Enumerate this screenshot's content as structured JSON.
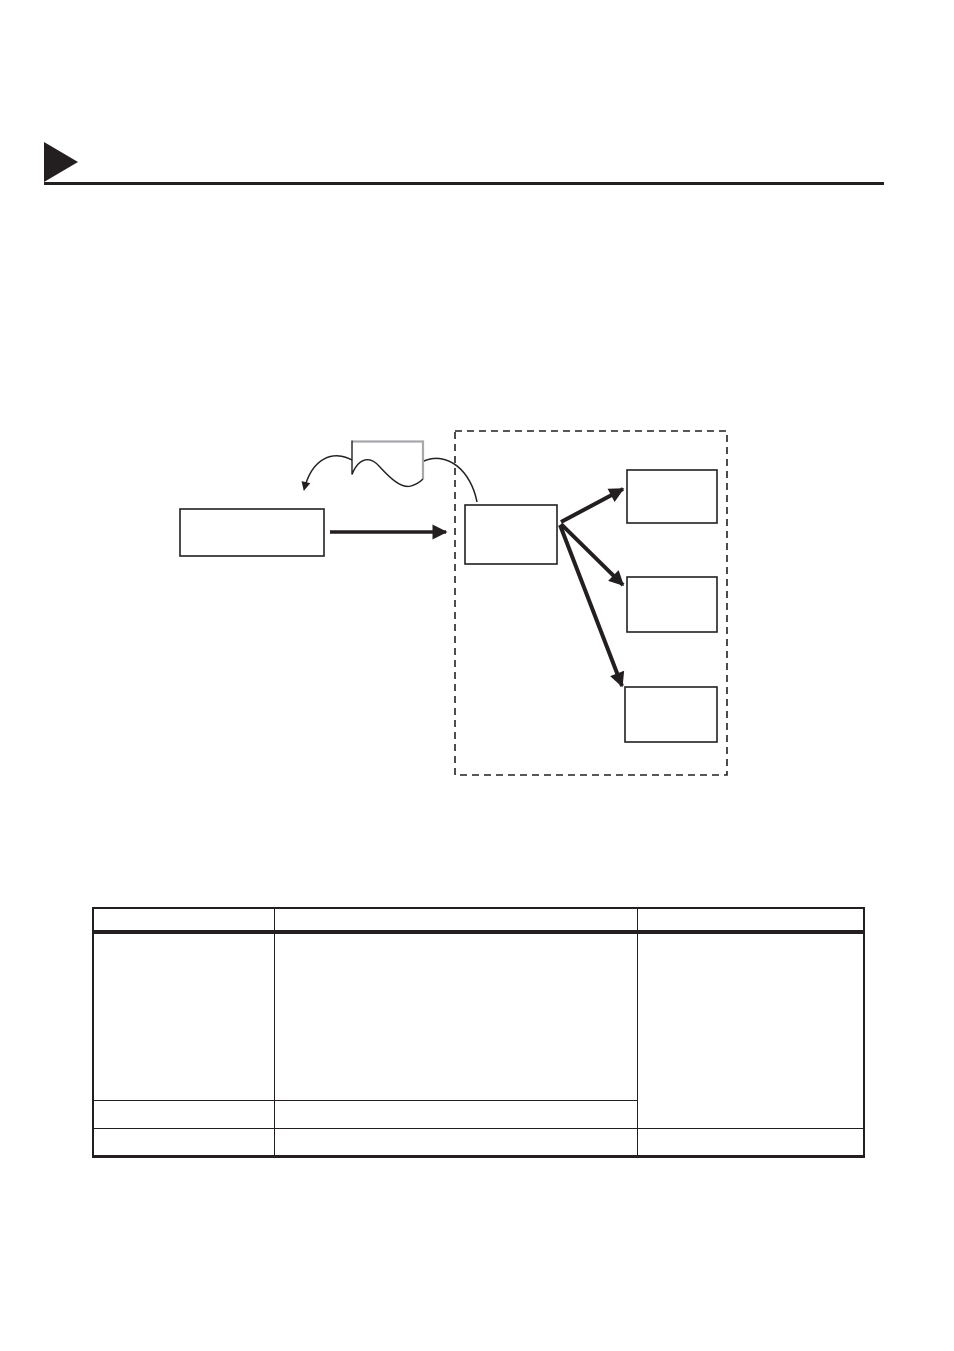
{
  "page": {
    "background_color": "#ffffff",
    "ink_color": "#231f20",
    "gray_accent_color": "#a7a9ac"
  },
  "header": {
    "marker_shape": "filled-right-triangle",
    "title_text": ""
  },
  "diagram": {
    "source_box_label": "",
    "document_shape_label": "",
    "hub_box_label": "",
    "destination_box_labels": [
      "",
      "",
      ""
    ],
    "group_outline_style": "dashed"
  },
  "table": {
    "header_cells": [
      "",
      "",
      ""
    ],
    "body": {
      "row1": {
        "col1": "",
        "col2": "",
        "col3_merged": ""
      },
      "row2": {
        "col1": "",
        "col2": ""
      },
      "row3": {
        "col1": "",
        "col2": "",
        "col3": ""
      }
    }
  }
}
